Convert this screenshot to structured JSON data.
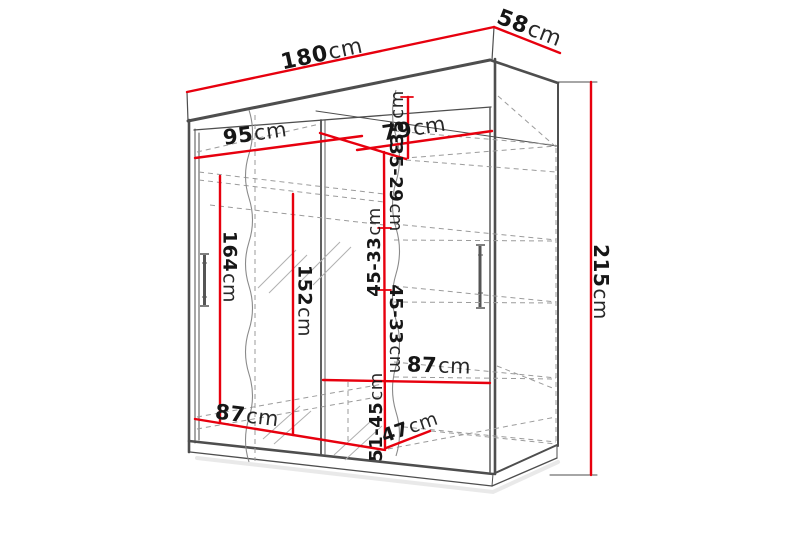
{
  "page": {
    "type": "product-dimension-diagram",
    "subject": "sliding-door wardrobe technical line drawing with dimension callouts",
    "background": "#ffffff"
  },
  "colors": {
    "dimension_line_red": "#e7000e",
    "outline_gray": "#4e4e4e",
    "dashed_gray": "#9b9b9b",
    "hatch_gray": "#b0b0b0",
    "label_text": "#161616"
  },
  "dims": {
    "d180": {
      "num": "180",
      "unit": "cm"
    },
    "d58": {
      "num": "58",
      "unit": "cm"
    },
    "d215": {
      "num": "215",
      "unit": "cm"
    },
    "d95": {
      "num": "95",
      "unit": "cm"
    },
    "d79": {
      "num": "79",
      "unit": "cm"
    },
    "d35": {
      "num": "35",
      "unit": "cm"
    },
    "d35_29": {
      "num": "35-29",
      "unit": "cm"
    },
    "d45_33_a": {
      "num": "45-33",
      "unit": "cm"
    },
    "d45_33_b": {
      "num": "45-33",
      "unit": "cm"
    },
    "d51_45": {
      "num": "51-45",
      "unit": "cm"
    },
    "d87_right": {
      "num": "87",
      "unit": "cm"
    },
    "d87_bottom": {
      "num": "87",
      "unit": "cm"
    },
    "d47": {
      "num": "47",
      "unit": "cm"
    },
    "d164": {
      "num": "164",
      "unit": "cm"
    },
    "d152": {
      "num": "152",
      "unit": "cm"
    }
  }
}
